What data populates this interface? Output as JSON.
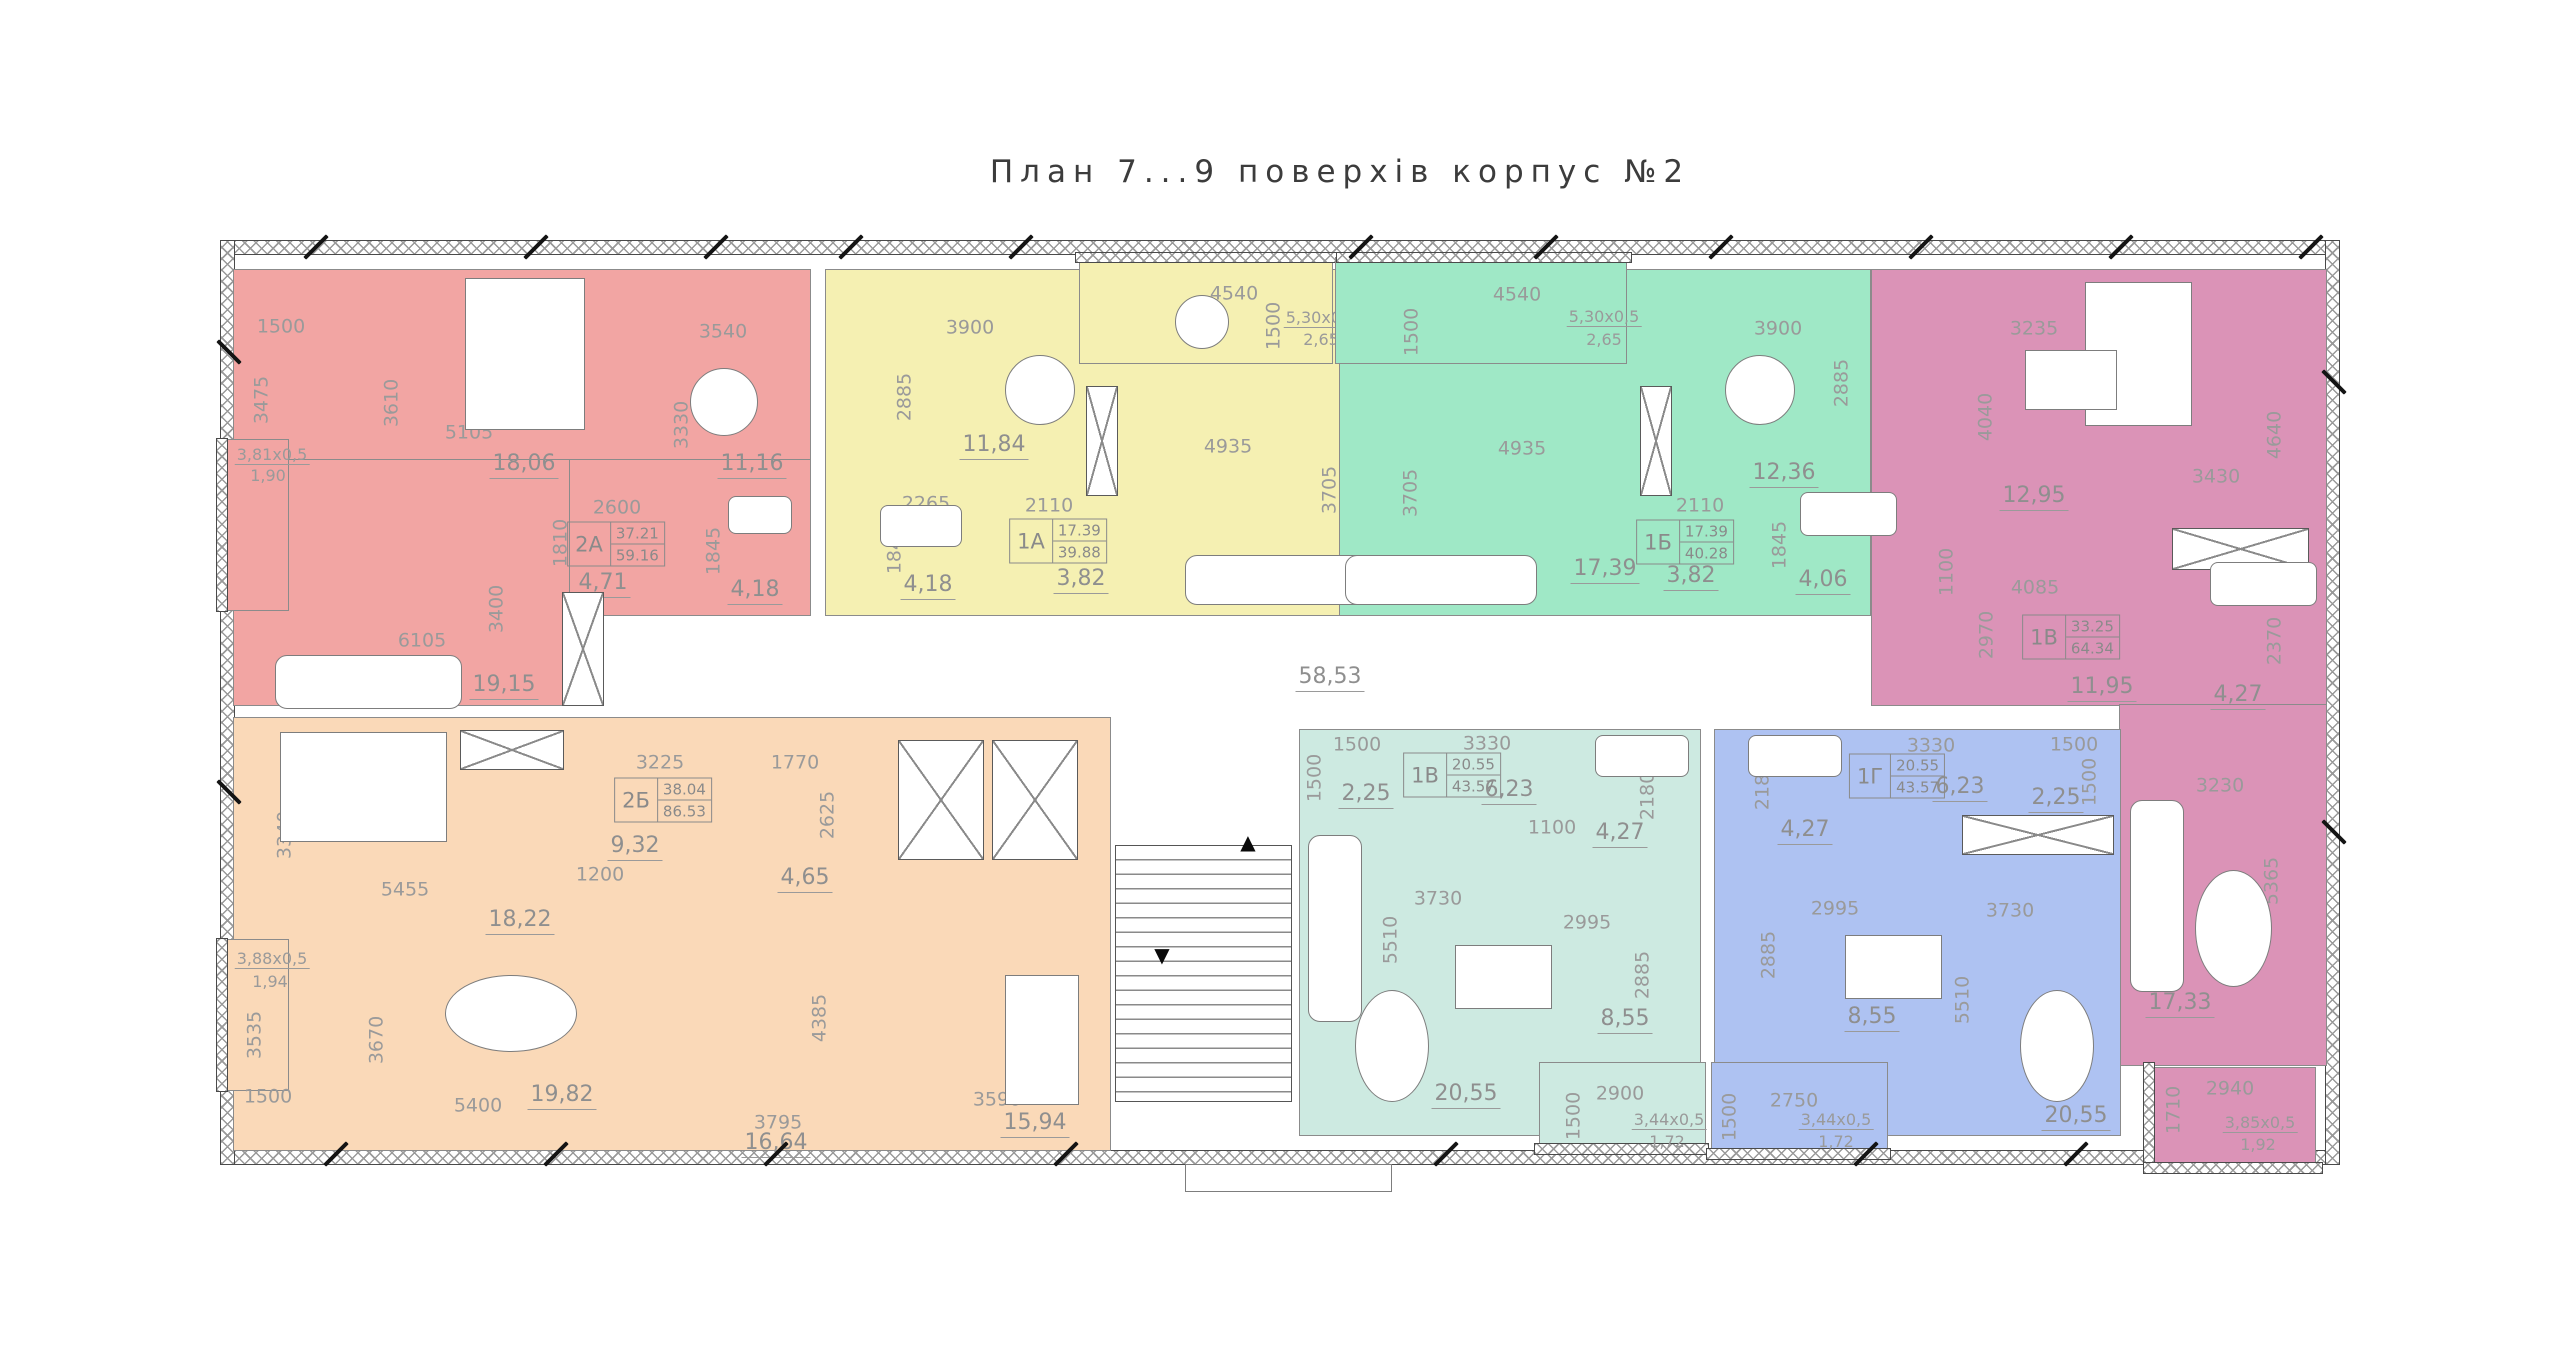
{
  "title": "План 7...9  поверхів  корпус  №2",
  "corridor": {
    "area": "58,53"
  },
  "icons": {
    "up_arrow": "▲",
    "down_arrow": "▼"
  },
  "colors": {
    "apt_2A": "#f2a5a3",
    "apt_1A": "#f5f0b2",
    "apt_1B": "#9fe8c6",
    "apt_1V_top": "#db93b7",
    "apt_2B": "#fad9b8",
    "apt_1V_bottom": "#cdeae1",
    "apt_1G": "#aec2f2",
    "walls": "#4a4a4a",
    "dims_text": "#9a9a9a"
  },
  "apartments": {
    "a2A": {
      "id": "2А",
      "upper": "37.21",
      "lower": "59.16",
      "rooms": {
        "bedroom": "18,06",
        "kitchen": "11,16",
        "hall": "4,71",
        "bath": "4,18",
        "living": "19,15",
        "balcony_size": "3,81x0,5",
        "balcony": "1,90"
      },
      "dims": [
        "1500",
        "3475",
        "3610",
        "5105",
        "3540",
        "3330",
        "2600",
        "1810",
        "1845",
        "2265",
        "3400",
        "6105"
      ]
    },
    "a1A": {
      "id": "1А",
      "upper": "17.39",
      "lower": "39.88",
      "rooms": {
        "kitchen": "11,84",
        "hall": "3,82",
        "bath": "4,18",
        "balcony_size": "5,30x0,5",
        "balcony": "2,65"
      },
      "dims": [
        "3900",
        "2885",
        "4540",
        "1500",
        "4935",
        "3705",
        "2265",
        "2110",
        "1845"
      ]
    },
    "a1B": {
      "id": "1Б",
      "upper": "17.39",
      "lower": "40.28",
      "rooms": {
        "living": "17,39",
        "kitchen": "12,36",
        "hall": "3,82",
        "bath": "4,06",
        "balcony_size": "5,30x0,5",
        "balcony": "2,65"
      },
      "dims": [
        "4540",
        "1500",
        "3900",
        "2885",
        "4935",
        "3705",
        "2110",
        "1845"
      ]
    },
    "a1V": {
      "id": "1В",
      "upper": "33.25",
      "lower": "64.34",
      "rooms": {
        "kitchen": "12,95",
        "hall": "11,95",
        "bath": "4,27",
        "living": "17,33",
        "balcony_size": "3,85x0,5",
        "balcony": "1,92"
      },
      "dims": [
        "3235",
        "4040",
        "3430",
        "4640",
        "4085",
        "2970",
        "1800",
        "2370",
        "1100",
        "3230",
        "5365",
        "2940",
        "1710"
      ]
    },
    "a2B": {
      "id": "2Б",
      "upper": "38.04",
      "lower": "86.53",
      "rooms": {
        "bedroom": "18,22",
        "hall": "9,32",
        "bath": "4,65",
        "living": "19,82",
        "dining": "16,64",
        "kitchen": "15,94",
        "balcony_size": "3,88x0,5",
        "balcony": "1,94"
      },
      "dims": [
        "3340",
        "5455",
        "3225",
        "1770",
        "2625",
        "1200",
        "3535",
        "1500",
        "3670",
        "5400",
        "4385",
        "3795",
        "3590",
        "4695"
      ]
    },
    "a1Vb": {
      "id": "1В",
      "upper": "20.55",
      "lower": "43.57",
      "rooms": {
        "hall": "2,25",
        "corridor": "6,23",
        "bath": "4,27",
        "kitchen": "8,55",
        "living": "20,55",
        "balcony_size": "3,44x0,5",
        "balcony": "1,72"
      },
      "dims": [
        "1500",
        "1500",
        "3330",
        "1100",
        "2180",
        "3730",
        "2995",
        "5510",
        "2885",
        "2900",
        "1500"
      ]
    },
    "a1G": {
      "id": "1Г",
      "upper": "20.55",
      "lower": "43.57",
      "rooms": {
        "corridor": "6,23",
        "hall": "2,25",
        "bath": "4,27",
        "kitchen": "8,55",
        "living": "20,55",
        "balcony_size": "3,44x0,5",
        "balcony": "1,72"
      },
      "dims": [
        "3330",
        "1500",
        "1500",
        "2180",
        "2995",
        "2885",
        "3730",
        "5510",
        "2750",
        "1500"
      ]
    }
  }
}
